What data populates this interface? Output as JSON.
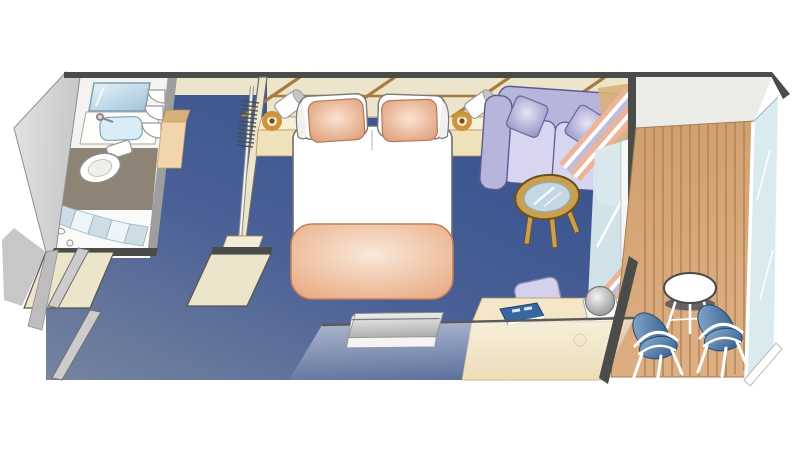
{
  "scene": {
    "type": "floor-plan",
    "areas": [
      "bathroom",
      "wardrobe",
      "bedroom",
      "sitting-area",
      "desk-area",
      "balcony",
      "entry"
    ],
    "furniture": [
      "double-bed",
      "white-pillows",
      "accent-pillows",
      "foot-blanket",
      "nightstands",
      "wall-lamps",
      "wardrobe-rail-with-hangers",
      "sofa",
      "throw-pillows",
      "coffee-table",
      "window-curtain",
      "sliding-glass-door",
      "desk",
      "desk-chair",
      "ice-bucket",
      "guest-book",
      "flat-tv",
      "vanity-sink",
      "mirror",
      "corner-shelves",
      "toilet",
      "shower",
      "entry-door",
      "balcony-table",
      "balcony-chairs",
      "glass-balustrade",
      "teak-deck"
    ]
  },
  "colors": {
    "outline": "#4b4b49",
    "wall_beige": "#ece4cb",
    "wall_beige_light": "#f4edd8",
    "wall_line_brown": "#a87c3e",
    "wood_trim": "#a8854a",
    "carpet_dark": "#34508c",
    "carpet_mid": "#4a6096",
    "carpet_light": "#76849f",
    "gray_wall": "#c7c7c7",
    "gray_wall_dark": "#9e9e9e",
    "gray_wall_light": "#e3e3e3",
    "bath_floor": "#8e8476",
    "bath_white": "#f4f3ef",
    "mirror_light": "#e8f4fa",
    "mirror_dark": "#9fc2d8",
    "sink": "#d9edf6",
    "shower_curtain": "#ccdde6",
    "deck_light": "#dcae82",
    "deck_dark": "#cf9f6e",
    "plank": "#b28154",
    "overhead": "#ebece8",
    "glass": "#d9ebee",
    "sofa": "#b7b5db",
    "sofa_light": "#d7d5ef",
    "sofa_dark": "#908dc0",
    "sofa_outline": "#5d5a92",
    "pillow_salmon": "#dd9d76",
    "pillow_salmon_light": "#fbe3d2",
    "blanket": "#e8a87f",
    "blanket_light": "#f9e9da",
    "blanket_outline": "#c2805a",
    "bed_white": "#ffffff",
    "bed_outline": "#6e6e6e",
    "nightstand_top": "#f8efd7",
    "nightstand_front": "#efe1ba",
    "lamp_gold": "#cd9440",
    "lamp_cap": "#c6c6c6",
    "table_wood": "#c99f52",
    "table_wood_dark": "#6d4f18",
    "table_glass": "#c3d8e2",
    "curtain_pink": "#eeb49a",
    "curtain_white": "#ffffff",
    "curtain_blue": "#bfbdd8",
    "desk_top": "#f4e6c6",
    "desk_front": "#eddcb4",
    "chair_blue": "#5b86b6",
    "chair_blue_dark": "#2b5687",
    "chair_frame": "#ffffff",
    "tv_light": "#f0f0f0",
    "tv_dark": "#ababab",
    "book_blue": "#38679f",
    "desk_chair": "#d3d1ec",
    "door_gray": "#cccccc",
    "cabinet_tan": "#f3d5ab",
    "cabinet_tan_dark": "#d9b07a",
    "table_white": "#ffffff",
    "shadow": "#54555d"
  }
}
